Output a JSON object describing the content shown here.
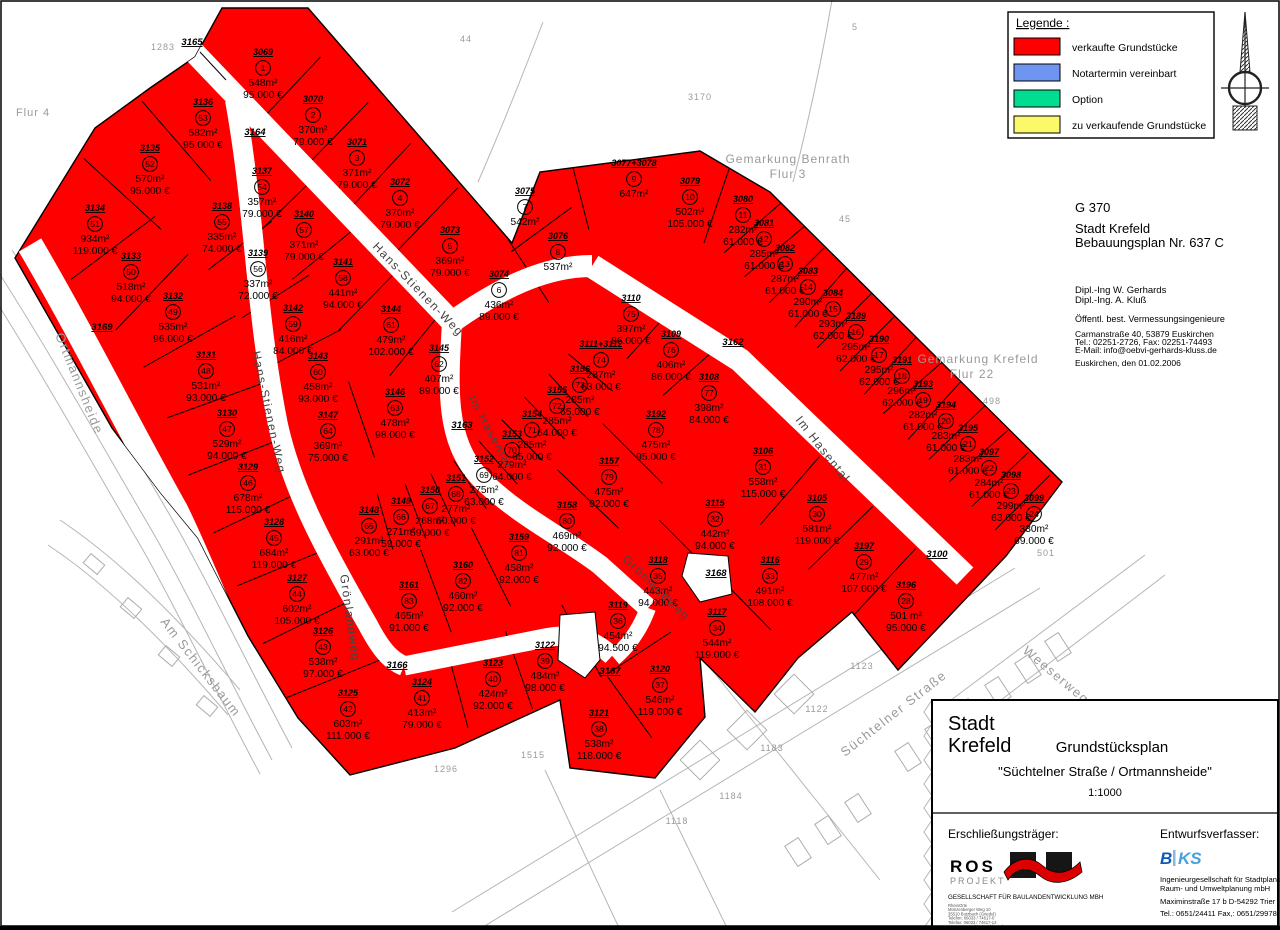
{
  "legend": {
    "title": "Legende :",
    "items": [
      {
        "label": "verkaufte Grundstücke",
        "color": "#ff0000"
      },
      {
        "label": "Notartermin vereinbart",
        "color": "#6e96f0"
      },
      {
        "label": "Option",
        "color": "#00dd90"
      },
      {
        "label": "zu verkaufende Grundstücke",
        "color": "#fbf96a"
      }
    ]
  },
  "plan_info": {
    "code": "G 370",
    "city": "Stadt Krefeld",
    "plan": "Bebauungsplan Nr. 637 C",
    "engineer1": "Dipl.-Ing W. Gerhards",
    "engineer2": "Dipl.-Ing. A. Kluß",
    "office": "Öffentl. best. Vermessungsingenieure",
    "addr1": "Carmanstraße 40, 53879 Euskirchen",
    "addr2": "Tel.: 02251-2726, Fax: 02251-74493",
    "addr3": "E-Mail: info@oebvi-gerhards-kluss.de",
    "date": "Euskirchen, den 01.02.2006"
  },
  "title_block": {
    "city1": "Stadt",
    "city2": "Krefeld",
    "title": "Grundstücksplan",
    "subtitle": "\"Süchtelner Straße / Ortmannsheide\"",
    "scale": "1:1000",
    "developer_label": "Erschließungsträger:",
    "developer_name": "ROS",
    "developer_name2": "PROJEKT",
    "developer_sub": "GESELLSCHAFT FÜR BAULANDENTWICKLUNG MBH",
    "developer_lines": [
      "RheinOrte",
      "Münzenberger Weg 10",
      "35510 Butzbach (Griedel)",
      "Telefon: 06033 / 74617-0",
      "Telefax: 06033 / 74617-12",
      "www.ros-projektentwicklung.de"
    ],
    "author_label": "Entwurfsverfasser:",
    "author_logo_b": "B",
    "author_logo_ks": "KS",
    "author_line1": "Ingenieurgesellschaft für Stadtplanung,",
    "author_line2": "Raum- und Umweltplanung mbH",
    "author_line3": "Maximinstraße 17 b    D-54292 Trier",
    "author_line4": "Tel.: 0651/24411    Fax,: 0651/29978"
  },
  "map": {
    "parcel_color": "#ff0000",
    "parcels": [
      {
        "n": "1",
        "fl": "3069",
        "a": "548m²",
        "p": "95.000 €",
        "x": 263,
        "y": 68
      },
      {
        "n": "2",
        "fl": "3070",
        "a": "370m²",
        "p": "79.000 €",
        "x": 313,
        "y": 115
      },
      {
        "n": "3",
        "fl": "3071",
        "a": "371m²",
        "p": "79.000 €",
        "x": 357,
        "y": 158
      },
      {
        "n": "4",
        "fl": "3072",
        "a": "370m²",
        "p": "79.000 €",
        "x": 400,
        "y": 198
      },
      {
        "n": "5",
        "fl": "3073",
        "a": "369m²",
        "p": "79.000 €",
        "x": 450,
        "y": 246
      },
      {
        "n": "6",
        "fl": "3074",
        "a": "436m²",
        "p": "89.000 €",
        "x": 499,
        "y": 290
      },
      {
        "n": "7",
        "fl": "3075",
        "a": "542m²",
        "p": "",
        "x": 525,
        "y": 207
      },
      {
        "n": "8",
        "fl": "3076",
        "a": "537m²",
        "p": "",
        "x": 558,
        "y": 252
      },
      {
        "n": "9",
        "fl": "3077+3078",
        "a": "647m²",
        "p": "",
        "x": 634,
        "y": 179
      },
      {
        "n": "10",
        "fl": "3079",
        "a": "502m²",
        "p": "105.000 €",
        "x": 690,
        "y": 197
      },
      {
        "n": "11",
        "fl": "3080",
        "a": "282m²",
        "p": "61.000 €",
        "x": 743,
        "y": 215
      },
      {
        "n": "12",
        "fl": "3081",
        "a": "285m²",
        "p": "61.000 €",
        "x": 764,
        "y": 239
      },
      {
        "n": "13",
        "fl": "3082",
        "a": "287m²",
        "p": "61.000 €",
        "x": 785,
        "y": 264
      },
      {
        "n": "14",
        "fl": "3083",
        "a": "290m²",
        "p": "61.000 €",
        "x": 808,
        "y": 287
      },
      {
        "n": "15",
        "fl": "3084",
        "a": "293m²",
        "p": "62.000 €",
        "x": 833,
        "y": 309
      },
      {
        "n": "16",
        "fl": "3189",
        "a": "295m²",
        "p": "62.000 €",
        "x": 856,
        "y": 332
      },
      {
        "n": "17",
        "fl": "3190",
        "a": "295m²",
        "p": "62.000 €",
        "x": 879,
        "y": 355
      },
      {
        "n": "18",
        "fl": "3191",
        "a": "296m²",
        "p": "62.000 €",
        "x": 902,
        "y": 376
      },
      {
        "n": "19",
        "fl": "3193",
        "a": "282m²",
        "p": "61.000 €",
        "x": 923,
        "y": 400
      },
      {
        "n": "20",
        "fl": "3194",
        "a": "283m²",
        "p": "61.000 €",
        "x": 946,
        "y": 421
      },
      {
        "n": "21",
        "fl": "3195",
        "a": "283m²",
        "p": "61.000 €",
        "x": 968,
        "y": 444
      },
      {
        "n": "22",
        "fl": "3097",
        "a": "284m²",
        "p": "61.000 €",
        "x": 989,
        "y": 468
      },
      {
        "n": "23",
        "fl": "3098",
        "a": "299m²",
        "p": "63.000 €",
        "x": 1011,
        "y": 491
      },
      {
        "n": "24",
        "fl": "3099",
        "a": "330m²",
        "p": "69.000 €",
        "x": 1034,
        "y": 514
      },
      {
        "n": "28",
        "fl": "3196",
        "a": "501 m²",
        "p": "95.000 €",
        "x": 906,
        "y": 601
      },
      {
        "n": "29",
        "fl": "3197",
        "a": "477m²",
        "p": "107.000 €",
        "x": 864,
        "y": 562
      },
      {
        "n": "30",
        "fl": "3105",
        "a": "581m²",
        "p": "119.000 €",
        "x": 817,
        "y": 514
      },
      {
        "n": "31",
        "fl": "3106",
        "a": "558m²",
        "p": "115.000 €",
        "x": 763,
        "y": 467
      },
      {
        "n": "32",
        "fl": "3115",
        "a": "442m²",
        "p": "94.000 €",
        "x": 715,
        "y": 519
      },
      {
        "n": "33",
        "fl": "3116",
        "a": "491m²",
        "p": "108.000 €",
        "x": 770,
        "y": 576
      },
      {
        "n": "34",
        "fl": "3117",
        "a": "544m²",
        "p": "119.000 €",
        "x": 717,
        "y": 628
      },
      {
        "n": "35",
        "fl": "3118",
        "a": "443m²",
        "p": "94.000 €",
        "x": 658,
        "y": 576
      },
      {
        "n": "36",
        "fl": "3119",
        "a": "454m²",
        "p": "94.500 €",
        "x": 618,
        "y": 621
      },
      {
        "n": "37",
        "fl": "3120",
        "a": "546m²",
        "p": "119.000 €",
        "x": 660,
        "y": 685
      },
      {
        "n": "38",
        "fl": "3121",
        "a": "538m²",
        "p": "118.000 €",
        "x": 599,
        "y": 729
      },
      {
        "n": "39",
        "fl": "3122",
        "a": "484m²",
        "p": "98.000 €",
        "x": 545,
        "y": 661
      },
      {
        "n": "40",
        "fl": "3123",
        "a": "424m²",
        "p": "92.000 €",
        "x": 493,
        "y": 679
      },
      {
        "n": "41",
        "fl": "3124",
        "a": "413m²",
        "p": "79.000 €",
        "x": 422,
        "y": 698
      },
      {
        "n": "42",
        "fl": "3125",
        "a": "603m²",
        "p": "111.000 €",
        "x": 348,
        "y": 709
      },
      {
        "n": "43",
        "fl": "3126",
        "a": "538m²",
        "p": "97.000 €",
        "x": 323,
        "y": 647
      },
      {
        "n": "44",
        "fl": "3127",
        "a": "602m²",
        "p": "105.000 €",
        "x": 297,
        "y": 594
      },
      {
        "n": "45",
        "fl": "3128",
        "a": "684m²",
        "p": "119.000 €",
        "x": 274,
        "y": 538
      },
      {
        "n": "46",
        "fl": "3129",
        "a": "678m²",
        "p": "115.000 €",
        "x": 248,
        "y": 483
      },
      {
        "n": "47",
        "fl": "3130",
        "a": "529m²",
        "p": "94.000 €",
        "x": 227,
        "y": 429
      },
      {
        "n": "48",
        "fl": "3131",
        "a": "531m²",
        "p": "93.000 €",
        "x": 206,
        "y": 371
      },
      {
        "n": "49",
        "fl": "3132",
        "a": "535m²",
        "p": "96.000 €",
        "x": 173,
        "y": 312
      },
      {
        "n": "50",
        "fl": "3133",
        "a": "518m²",
        "p": "94.000 €",
        "x": 131,
        "y": 272
      },
      {
        "n": "51",
        "fl": "3134",
        "a": "934m²",
        "p": "119.000 €",
        "x": 95,
        "y": 224
      },
      {
        "n": "52",
        "fl": "3135",
        "a": "570m²",
        "p": "95.000 €",
        "x": 150,
        "y": 164
      },
      {
        "n": "53",
        "fl": "3136",
        "a": "582m²",
        "p": "95.000 €",
        "x": 203,
        "y": 118
      },
      {
        "n": "54",
        "fl": "3137",
        "a": "357m²",
        "p": "79.000 €",
        "x": 262,
        "y": 187
      },
      {
        "n": "55",
        "fl": "3138",
        "a": "335m²",
        "p": "74.000 €",
        "x": 222,
        "y": 222
      },
      {
        "n": "56",
        "fl": "3139",
        "a": "337m²",
        "p": "72.000 €",
        "x": 258,
        "y": 269
      },
      {
        "n": "57",
        "fl": "3140",
        "a": "371m²",
        "p": "79.000 €",
        "x": 304,
        "y": 230
      },
      {
        "n": "58",
        "fl": "3141",
        "a": "441m²",
        "p": "94.000 €",
        "x": 343,
        "y": 278
      },
      {
        "n": "59",
        "fl": "3142",
        "a": "416m²",
        "p": "84.000 €",
        "x": 293,
        "y": 324
      },
      {
        "n": "60",
        "fl": "3143",
        "a": "458m²",
        "p": "93.000 €",
        "x": 318,
        "y": 372
      },
      {
        "n": "61",
        "fl": "3144",
        "a": "479m²",
        "p": "102.000 €",
        "x": 391,
        "y": 325
      },
      {
        "n": "62",
        "fl": "3145",
        "a": "407m²",
        "p": "89.000 €",
        "x": 439,
        "y": 364
      },
      {
        "n": "63",
        "fl": "3146",
        "a": "478m²",
        "p": "98.000 €",
        "x": 395,
        "y": 408
      },
      {
        "n": "64",
        "fl": "3147",
        "a": "369m²",
        "p": "75.000 €",
        "x": 328,
        "y": 431
      },
      {
        "n": "65",
        "fl": "3148",
        "a": "291m²",
        "p": "63.000 €",
        "x": 369,
        "y": 526
      },
      {
        "n": "66",
        "fl": "3149",
        "a": "271m²",
        "p": "59.000 €",
        "x": 401,
        "y": 517
      },
      {
        "n": "67",
        "fl": "3150",
        "a": "268m²",
        "p": "59.000 €",
        "x": 430,
        "y": 506
      },
      {
        "n": "68",
        "fl": "3151",
        "a": "277m²",
        "p": "60.000 €",
        "x": 456,
        "y": 494
      },
      {
        "n": "69",
        "fl": "3152",
        "a": "275m²",
        "p": "63.000 €",
        "x": 484,
        "y": 475
      },
      {
        "n": "70",
        "fl": "3153",
        "a": "279m²",
        "p": "64.000 €",
        "x": 512,
        "y": 450
      },
      {
        "n": "71",
        "fl": "3154",
        "a": "285m²",
        "p": "65.000 €",
        "x": 532,
        "y": 430
      },
      {
        "n": "72",
        "fl": "3155",
        "a": "285m²",
        "p": "64.000 €",
        "x": 557,
        "y": 406
      },
      {
        "n": "73",
        "fl": "3156",
        "a": "285m²",
        "p": "65.000 €",
        "x": 580,
        "y": 385
      },
      {
        "n": "74",
        "fl": "3111+3112",
        "a": "287m²",
        "p": "63.000 €",
        "x": 601,
        "y": 360
      },
      {
        "n": "75",
        "fl": "3110",
        "a": "397m²",
        "p": "86.000 €",
        "x": 631,
        "y": 314
      },
      {
        "n": "76",
        "fl": "3109",
        "a": "406m²",
        "p": "86.000 €",
        "x": 671,
        "y": 350
      },
      {
        "n": "77",
        "fl": "3108",
        "a": "398m²",
        "p": "84.000 €",
        "x": 709,
        "y": 393
      },
      {
        "n": "78",
        "fl": "3192",
        "a": "475m²",
        "p": "95.000 €",
        "x": 656,
        "y": 430
      },
      {
        "n": "79",
        "fl": "3157",
        "a": "475m²",
        "p": "92.000 €",
        "x": 609,
        "y": 477
      },
      {
        "n": "80",
        "fl": "3158",
        "a": "469m²",
        "p": "92.000 €",
        "x": 567,
        "y": 521
      },
      {
        "n": "81",
        "fl": "3159",
        "a": "458m²",
        "p": "92.000 €",
        "x": 519,
        "y": 553
      },
      {
        "n": "82",
        "fl": "3160",
        "a": "460m²",
        "p": "92.000 €",
        "x": 463,
        "y": 581
      },
      {
        "n": "83",
        "fl": "3161",
        "a": "465m²",
        "p": "91.000 €",
        "x": 409,
        "y": 601
      }
    ],
    "strips": [
      {
        "seq": [
          1,
          2,
          3,
          4,
          5
        ],
        "w": 95
      },
      {
        "seq": [
          53,
          52,
          51,
          50,
          49,
          48,
          47,
          46,
          45,
          44,
          43,
          42
        ],
        "w": 105
      },
      {
        "seq": [
          55,
          56,
          59,
          60
        ],
        "w": 80
      },
      {
        "seq": [
          54,
          57,
          58,
          61,
          62
        ],
        "w": 80
      },
      {
        "seq": [
          63,
          64
        ],
        "w": 80
      },
      {
        "seq": [
          6,
          8
        ],
        "w": 75
      },
      {
        "seq": [
          8,
          7
        ],
        "w": 75
      },
      {
        "seq": [
          7,
          9
        ],
        "w": 75
      },
      {
        "seq": [
          10,
          11,
          12,
          13,
          14,
          15,
          16,
          17,
          18,
          19,
          20,
          21,
          22,
          23,
          24
        ],
        "w": 78
      },
      {
        "seq": [
          75,
          76,
          77
        ],
        "w": 72
      },
      {
        "seq": [
          74,
          73,
          72,
          71,
          70,
          69,
          68,
          67,
          66,
          65
        ],
        "w": 58
      },
      {
        "seq": [
          78,
          79,
          80
        ],
        "w": 85
      },
      {
        "seq": [
          81,
          82,
          83
        ],
        "w": 88
      },
      {
        "seq": [
          31,
          30,
          29,
          28
        ],
        "w": 90
      },
      {
        "seq": [
          35,
          32
        ],
        "w": 78
      },
      {
        "seq": [
          34,
          33
        ],
        "w": 78
      },
      {
        "seq": [
          41,
          40,
          39,
          36
        ],
        "w": 82
      },
      {
        "seq": [
          36,
          37
        ],
        "w": 76
      },
      {
        "seq": [
          37,
          38
        ],
        "w": 76
      }
    ],
    "street_labels": [
      {
        "text": "Hans-Stienen-Weg",
        "x": 372,
        "y": 247,
        "rot": 46,
        "c": "#444",
        "s": 12
      },
      {
        "text": "Hans-Stienen-Weg",
        "x": 252,
        "y": 352,
        "rot": 78,
        "c": "#444",
        "s": 12
      },
      {
        "text": "Im Hasental",
        "x": 468,
        "y": 398,
        "rot": 62,
        "c": "#444",
        "s": 12
      },
      {
        "text": "Im Hasental",
        "x": 795,
        "y": 420,
        "rot": 52,
        "c": "#444",
        "s": 12
      },
      {
        "text": "Grönlandweg",
        "x": 340,
        "y": 575,
        "rot": 82,
        "c": "#444",
        "s": 12
      },
      {
        "text": "Grönlandweg",
        "x": 622,
        "y": 560,
        "rot": 44,
        "c": "#444",
        "s": 12
      },
      {
        "text": "Ortmannsheide",
        "x": 55,
        "y": 335,
        "rot": 68,
        "c": "#9a9a9a",
        "s": 13
      },
      {
        "text": "Am Schicksbaum",
        "x": 160,
        "y": 622,
        "rot": 52,
        "c": "#9a9a9a",
        "s": 13
      },
      {
        "text": "Weeserweg",
        "x": 1022,
        "y": 652,
        "rot": 40,
        "c": "#9a9a9a",
        "s": 13
      },
      {
        "text": "Süchtelner Straße",
        "x": 845,
        "y": 757,
        "rot": -38,
        "c": "#9a9a9a",
        "s": 13
      }
    ],
    "lot_labels": [
      {
        "text": "3164",
        "x": 255,
        "y": 135
      },
      {
        "text": "3165",
        "x": 192,
        "y": 45
      },
      {
        "text": "3163",
        "x": 462,
        "y": 428
      },
      {
        "text": "3162",
        "x": 733,
        "y": 345
      },
      {
        "text": "3166",
        "x": 397,
        "y": 668
      },
      {
        "text": "3167",
        "x": 610,
        "y": 674
      },
      {
        "text": "3168",
        "x": 716,
        "y": 576
      },
      {
        "text": "3100",
        "x": 937,
        "y": 557
      },
      {
        "text": "3169",
        "x": 102,
        "y": 330
      }
    ],
    "context_labels": [
      {
        "text": "Flur 4",
        "x": 33,
        "y": 116,
        "s": 11
      },
      {
        "text": "1283",
        "x": 163,
        "y": 50,
        "s": 9
      },
      {
        "text": "44",
        "x": 466,
        "y": 42,
        "s": 9
      },
      {
        "text": "3170",
        "x": 700,
        "y": 100,
        "s": 9
      },
      {
        "text": "5",
        "x": 855,
        "y": 30,
        "s": 9
      },
      {
        "text": "45",
        "x": 845,
        "y": 222,
        "s": 9
      },
      {
        "text": "Gemarkung Benrath",
        "x": 788,
        "y": 163,
        "s": 12
      },
      {
        "text": "Flur 3",
        "x": 788,
        "y": 178,
        "s": 12
      },
      {
        "text": "Gemarkung Krefeld",
        "x": 978,
        "y": 363,
        "s": 12
      },
      {
        "text": "Flur 22",
        "x": 972,
        "y": 378,
        "s": 12
      },
      {
        "text": "498",
        "x": 992,
        "y": 404,
        "s": 9
      },
      {
        "text": "501",
        "x": 1046,
        "y": 556,
        "s": 9
      },
      {
        "text": "1123",
        "x": 862,
        "y": 669,
        "s": 9
      },
      {
        "text": "1122",
        "x": 817,
        "y": 712,
        "s": 9
      },
      {
        "text": "1183",
        "x": 772,
        "y": 751,
        "s": 9
      },
      {
        "text": "1184",
        "x": 731,
        "y": 799,
        "s": 9
      },
      {
        "text": "1118",
        "x": 677,
        "y": 824,
        "s": 9
      },
      {
        "text": "1296",
        "x": 446,
        "y": 772,
        "s": 9
      },
      {
        "text": "1515",
        "x": 533,
        "y": 758,
        "s": 9
      }
    ]
  }
}
